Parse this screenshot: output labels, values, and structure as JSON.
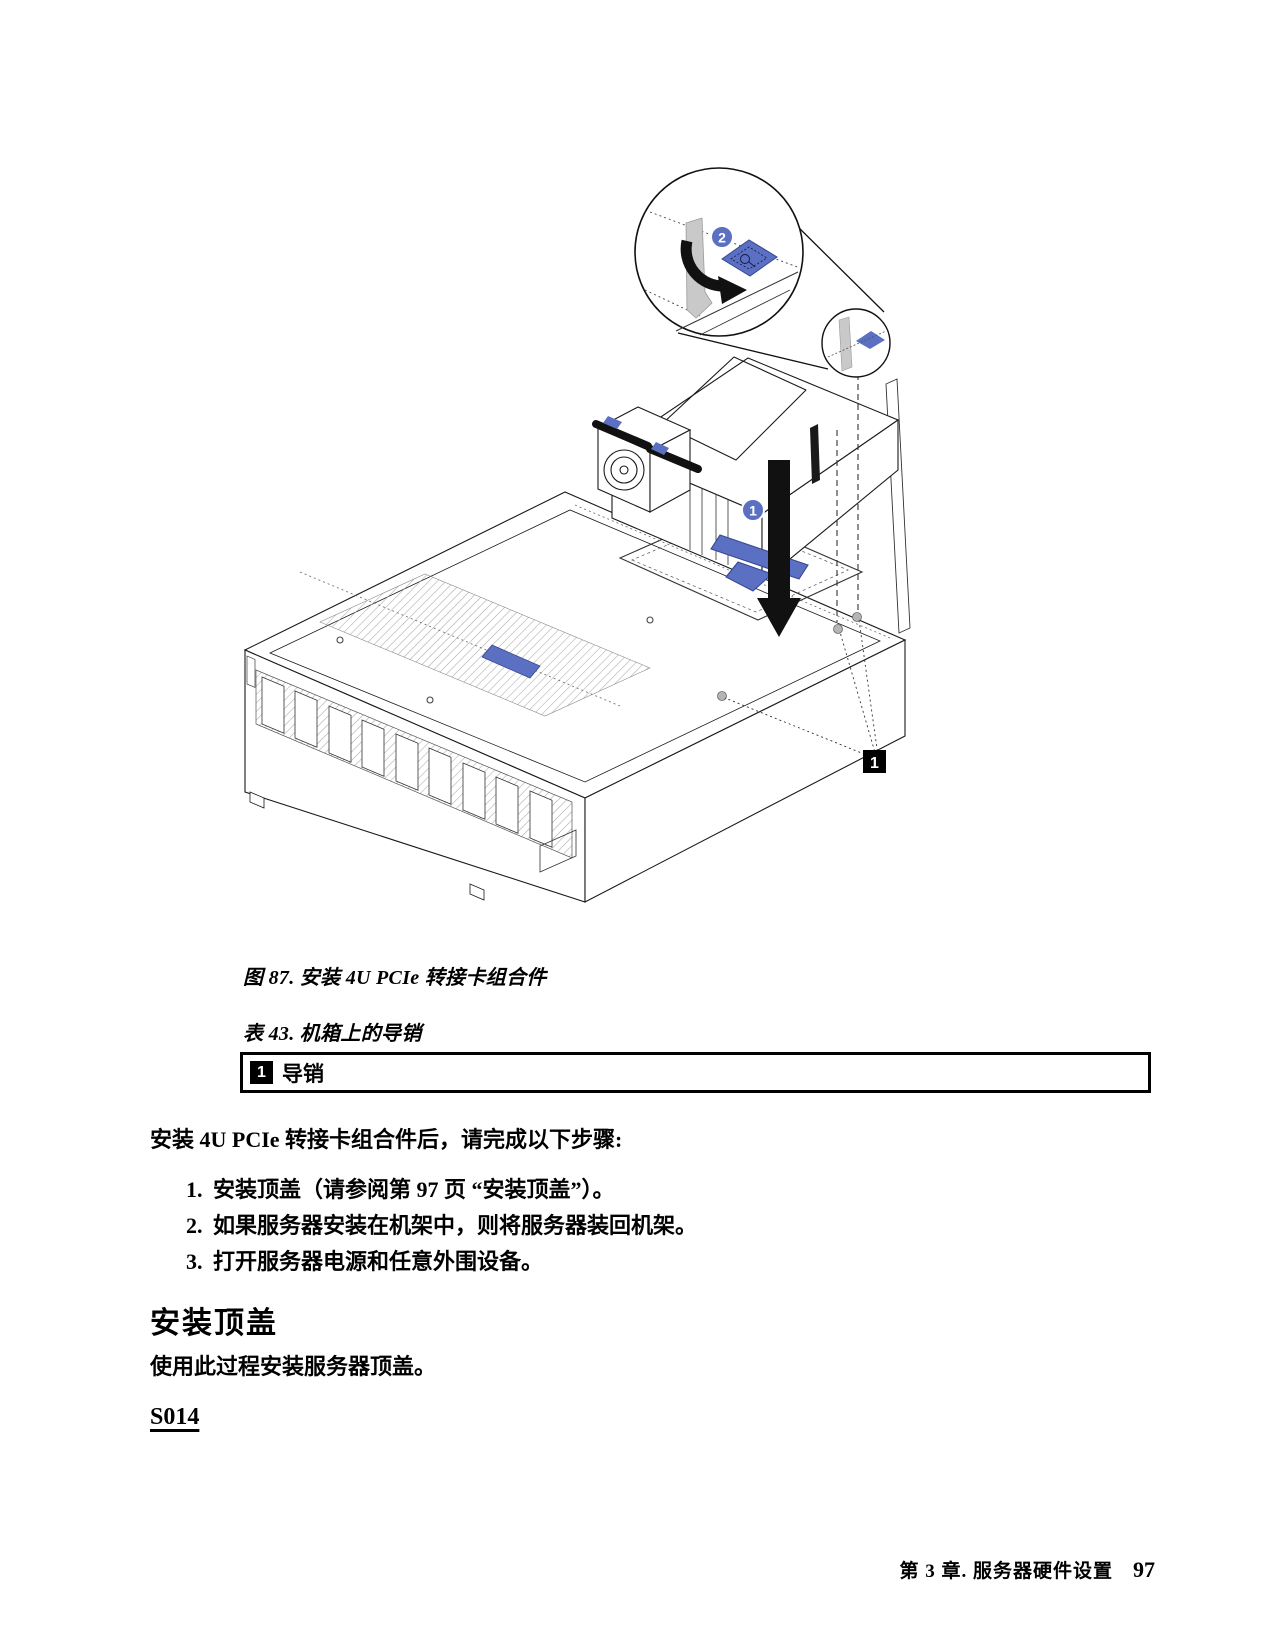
{
  "figure": {
    "caption": "图 87. 安装 4U PCIe 转接卡组合件",
    "callout_install_step": "1",
    "callout_latch_step": "2",
    "guide_pin_label": "1"
  },
  "table": {
    "caption": "表 43. 机箱上的导销",
    "rows": [
      {
        "badge": "1",
        "label": "导销"
      }
    ]
  },
  "content": {
    "intro": "安装 4U PCIe 转接卡组合件后，请完成以下步骤:",
    "steps": [
      {
        "num": "1.",
        "text": "安装顶盖（请参阅第 97 页 “安装顶盖”）。"
      },
      {
        "num": "2.",
        "text": "如果服务器安装在机架中，则将服务器装回机架。"
      },
      {
        "num": "3.",
        "text": "打开服务器电源和任意外围设备。"
      }
    ],
    "section_heading": "安装顶盖",
    "section_body": "使用此过程安装服务器顶盖。",
    "safety_link": "S014"
  },
  "footer": {
    "chapter": "第 3 章. 服务器硬件设置",
    "page": "97"
  },
  "colors": {
    "accent_blue": "#5b70c2",
    "line_black": "#1a1a1a",
    "gray_part": "#c9c9c9"
  }
}
